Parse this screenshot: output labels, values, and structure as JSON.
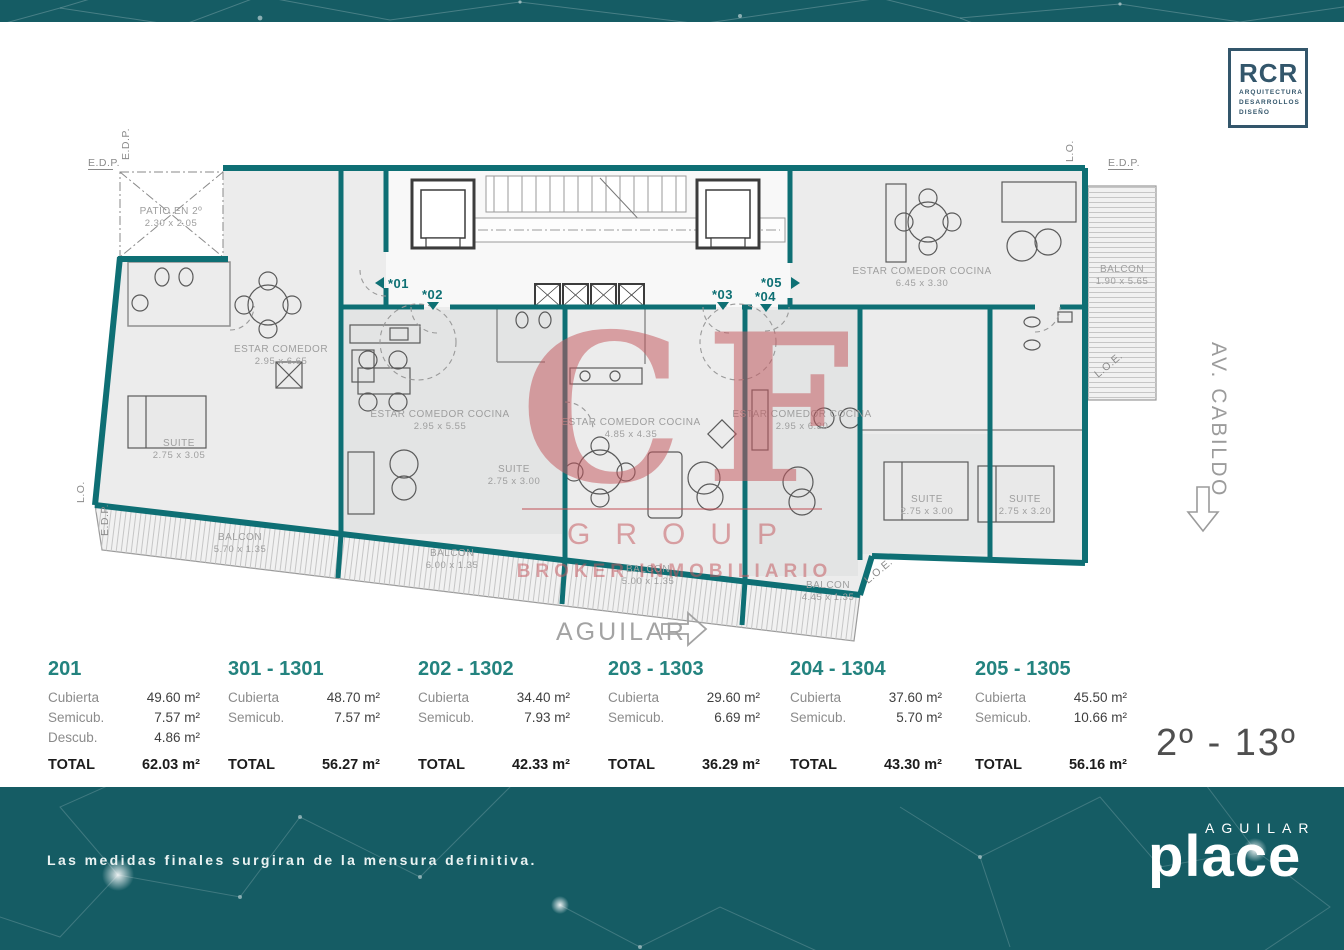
{
  "brand_rcr": {
    "name": "RCR",
    "lines": [
      "ARQUITECTURA",
      "DESARROLLOS",
      "DISEÑO"
    ]
  },
  "plan": {
    "edge_labels": {
      "edp": "E.D.P.",
      "lo": "L.O.",
      "loe": "L.O.E."
    },
    "patio": {
      "name": "PATIO EN 2º",
      "dims": "2.30 x 2.05"
    },
    "rooms": [
      {
        "name": "ESTAR COMEDOR",
        "dims": "2.95 x 6.65"
      },
      {
        "name": "SUITE",
        "dims": "2.75 x 3.05"
      },
      {
        "name": "ESTAR COMEDOR COCINA",
        "dims": "2.95 x 5.55"
      },
      {
        "name": "SUITE",
        "dims": "2.75 x 3.00"
      },
      {
        "name": "ESTAR COMEDOR COCINA",
        "dims": "4.85 x 4.35"
      },
      {
        "name": "ESTAR COMEDOR COCINA",
        "dims": "2.95 x 6.30"
      },
      {
        "name": "SUITE",
        "dims": "2.75 x 3.00"
      },
      {
        "name": "SUITE",
        "dims": "2.75 x 3.20"
      },
      {
        "name": "ESTAR COMEDOR COCINA",
        "dims": "6.45 x 3.30"
      }
    ],
    "balconies": [
      {
        "name": "BALCON",
        "dims": "5.70 x 1.35"
      },
      {
        "name": "BALCON",
        "dims": "6.00 x 1.35"
      },
      {
        "name": "BALCON",
        "dims": "5.00 x 1.35"
      },
      {
        "name": "BALCON",
        "dims": "4.45 x 1.35"
      },
      {
        "name": "BALCON",
        "dims": "1.90 x 5.65"
      }
    ],
    "entries": [
      {
        "label": "*01"
      },
      {
        "label": "*02"
      },
      {
        "label": "*03"
      },
      {
        "label": "*04"
      },
      {
        "label": "*05"
      }
    ],
    "street": "AV. CABILDO",
    "direction": "AGUILAR"
  },
  "watermark": {
    "monogram": "CF",
    "group": "GROUP",
    "tagline": "BROKER INMOBILIARIO"
  },
  "units": [
    {
      "id": "201",
      "rows": [
        {
          "label": "Cubierta",
          "value": "49.60 m²"
        },
        {
          "label": "Semicub.",
          "value": "7.57 m²"
        },
        {
          "label": "Descub.",
          "value": "4.86 m²"
        }
      ],
      "total_label": "TOTAL",
      "total": "62.03 m²"
    },
    {
      "id": "301 - 1301",
      "rows": [
        {
          "label": "Cubierta",
          "value": "48.70 m²"
        },
        {
          "label": "Semicub.",
          "value": "7.57 m²"
        }
      ],
      "total_label": "TOTAL",
      "total": "56.27 m²"
    },
    {
      "id": "202 - 1302",
      "rows": [
        {
          "label": "Cubierta",
          "value": "34.40 m²"
        },
        {
          "label": "Semicub.",
          "value": "7.93 m²"
        }
      ],
      "total_label": "TOTAL",
      "total": "42.33 m²"
    },
    {
      "id": "203 - 1303",
      "rows": [
        {
          "label": "Cubierta",
          "value": "29.60 m²"
        },
        {
          "label": "Semicub.",
          "value": "6.69 m²"
        }
      ],
      "total_label": "TOTAL",
      "total": "36.29 m²"
    },
    {
      "id": "204 - 1304",
      "rows": [
        {
          "label": "Cubierta",
          "value": "37.60 m²"
        },
        {
          "label": "Semicub.",
          "value": "5.70 m²"
        }
      ],
      "total_label": "TOTAL",
      "total": "43.30 m²"
    },
    {
      "id": "205 - 1305",
      "rows": [
        {
          "label": "Cubierta",
          "value": "45.50 m²"
        },
        {
          "label": "Semicub.",
          "value": "10.66 m²"
        }
      ],
      "total_label": "TOTAL",
      "total": "56.16 m²"
    }
  ],
  "floors_label": "2º - 13º",
  "footer": {
    "disclaimer": "Las medidas finales surgiran de la mensura definitiva.",
    "brand_top": "AGUILAR",
    "brand_bottom": "place"
  },
  "colors": {
    "teal_band": "#155c64",
    "wall_teal": "#0e6f74",
    "unit_title_teal": "#23837f",
    "watermark_red": "#c4585e",
    "logo_navy": "#33566b"
  }
}
